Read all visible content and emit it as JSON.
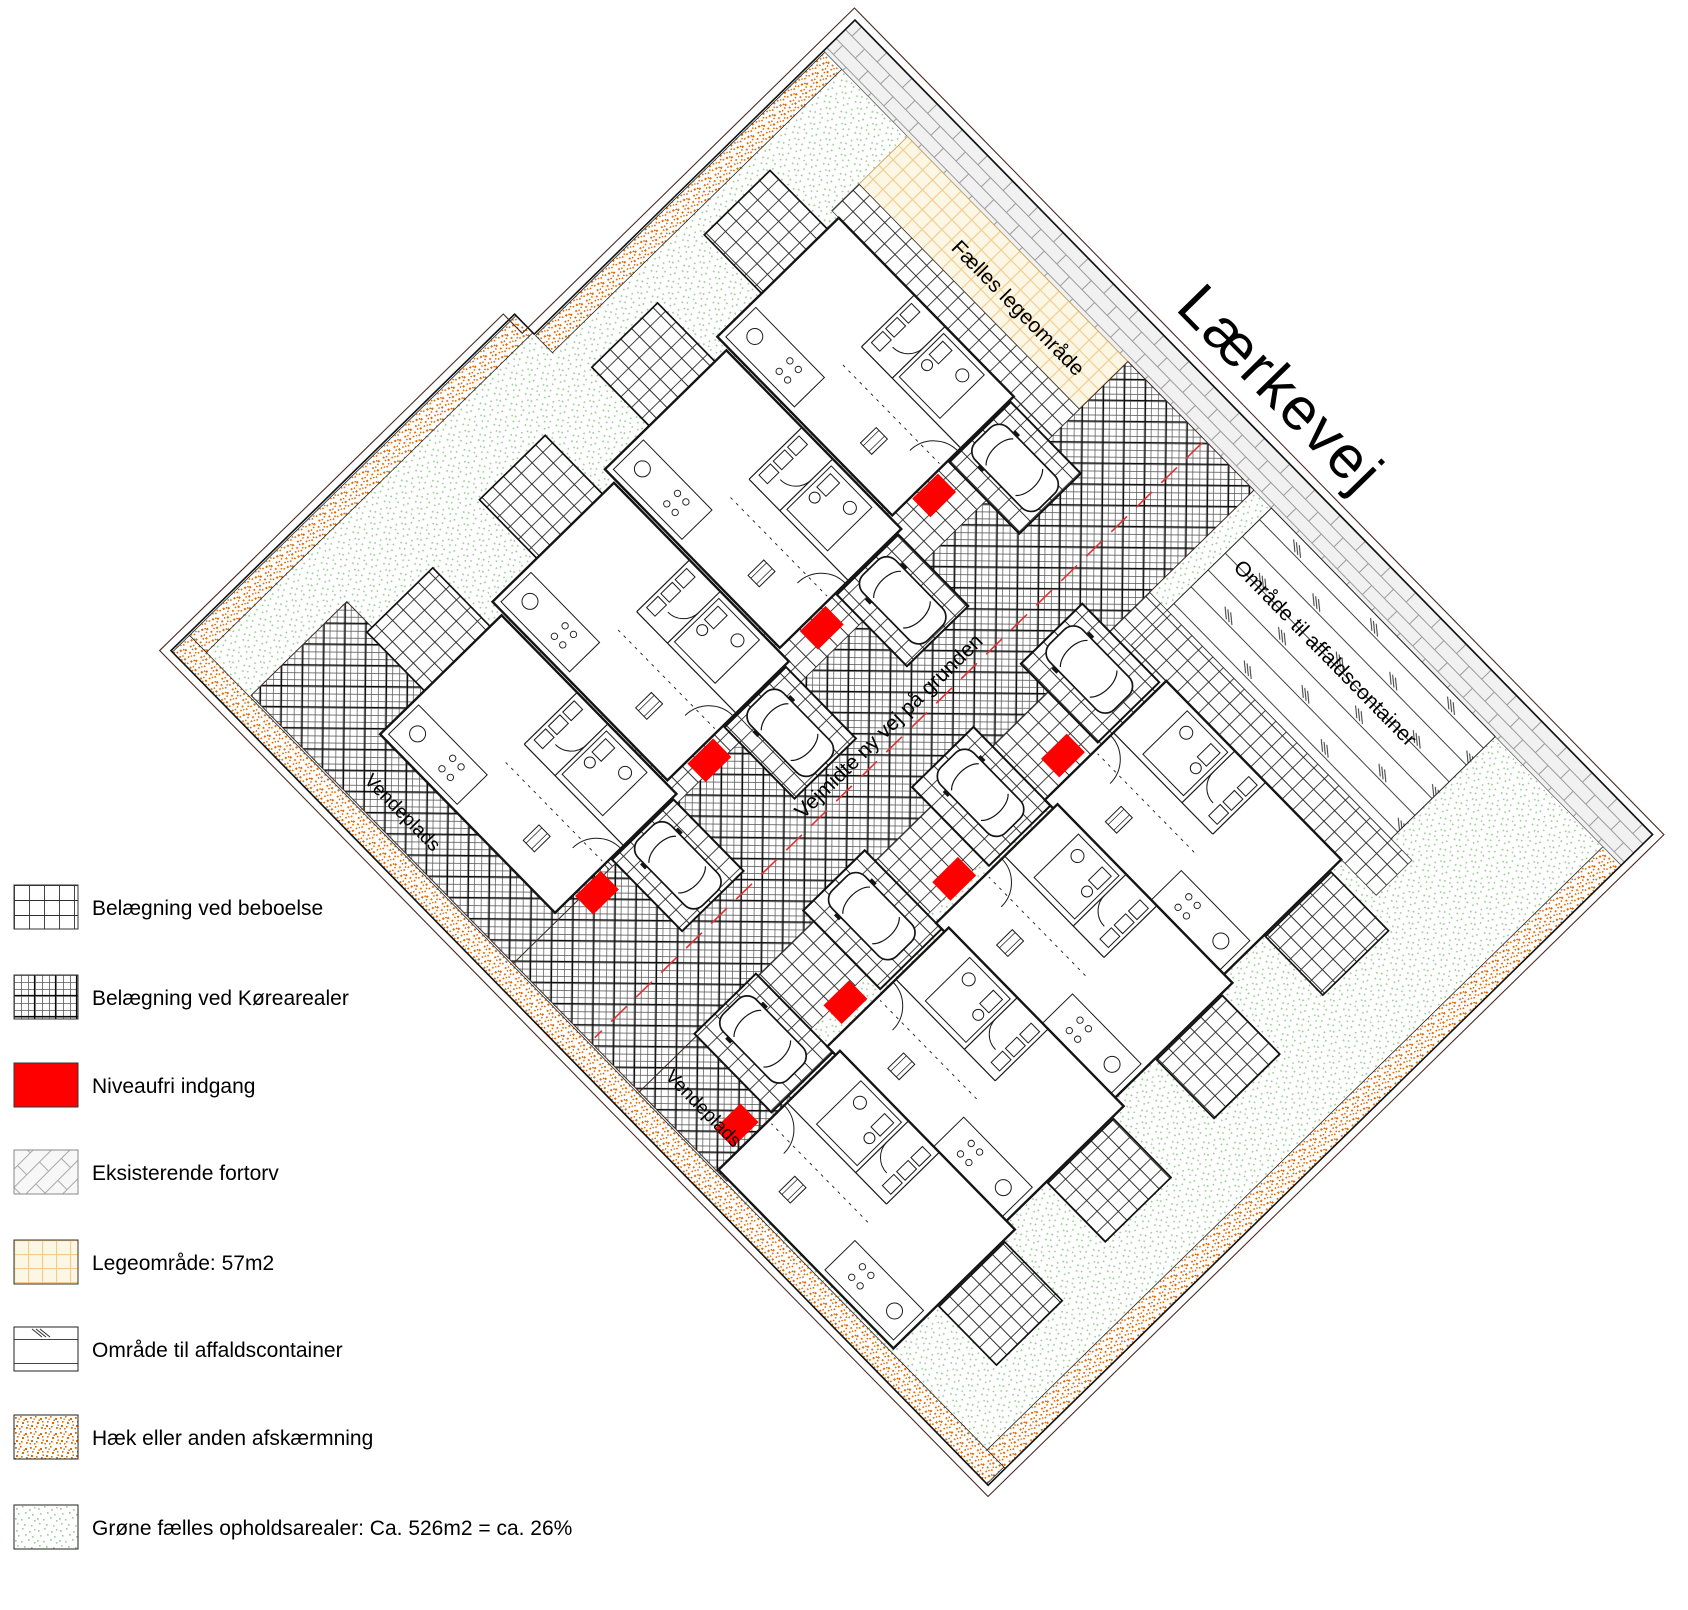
{
  "site_plan": {
    "street_label": "Lærkevej",
    "road_centerline_label": "Vejmidte ny vej på grunden",
    "play_area_label": "Fælles legeområde",
    "waste_area_label": "Område til affaldscontainer",
    "turning_area_label_1": "Vendeplads",
    "turning_area_label_2": "Vendeplads"
  },
  "legend": {
    "items": [
      {
        "id": "beboelse",
        "label": "Belægning ved beboelse"
      },
      {
        "id": "koerearealer",
        "label": "Belægning ved Kørearealer"
      },
      {
        "id": "niveaufri",
        "label": "Niveaufri indgang"
      },
      {
        "id": "fortorv",
        "label": "Eksisterende fortorv"
      },
      {
        "id": "legeomraade",
        "label": "Legeområde: 57m2"
      },
      {
        "id": "affald",
        "label": "Område til affaldscontainer"
      },
      {
        "id": "haek",
        "label": "Hæk eller anden afskærmning"
      },
      {
        "id": "groen",
        "label": "Grøne fælles opholdsarealer: Ca. 526m2 = ca. 26%"
      }
    ]
  },
  "colors": {
    "entrance_red": "#ff0000",
    "hedge_orange": "#e06a00",
    "green_dots": "#9ccf97",
    "play_area_lines": "#f0cd8e",
    "brick_gray": "#9b9b9b"
  }
}
